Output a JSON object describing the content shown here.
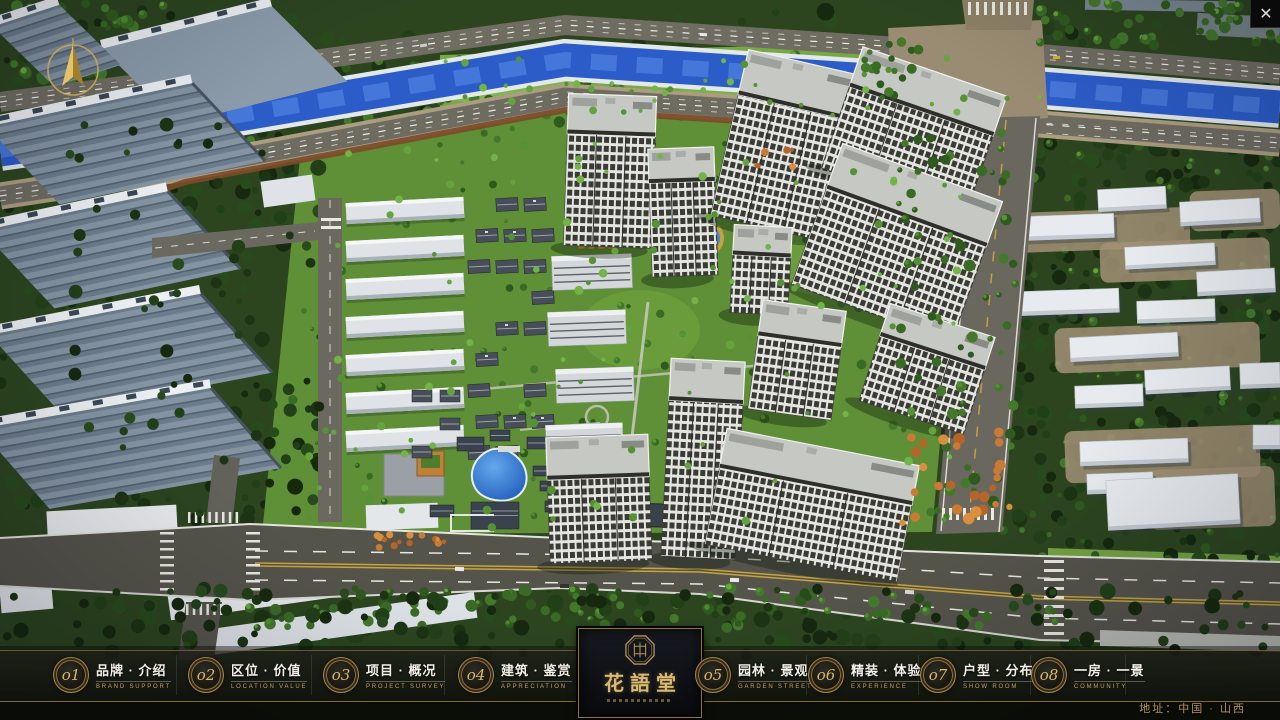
{
  "window": {
    "close_glyph": "✕"
  },
  "nav": {
    "items": [
      {
        "num": "o1",
        "zh": "品牌 · 介绍",
        "en": "BRAND SUPPORT"
      },
      {
        "num": "o2",
        "zh": "区位 · 价值",
        "en": "LOCATION VALUE"
      },
      {
        "num": "o3",
        "zh": "项目 · 概况",
        "en": "PROJECT SURVEY"
      },
      {
        "num": "o4",
        "zh": "建筑 · 鉴赏",
        "en": "APPRECIATION"
      },
      {
        "num": "o5",
        "zh": "园林 · 景观",
        "en": "GARDEN STREET"
      },
      {
        "num": "o6",
        "zh": "精装 · 体验",
        "en": "EXPERIENCE"
      },
      {
        "num": "o7",
        "zh": "户型 · 分布",
        "en": "SHOW ROOM"
      },
      {
        "num": "o8",
        "zh": "一房 · 一景",
        "en": "COMMUNITY"
      }
    ]
  },
  "logo": {
    "title": "花語堂"
  },
  "footer": {
    "address": "地址：中国 · 山西"
  },
  "colors": {
    "gold": "#c2a05a",
    "tree_dark": "#1c3413",
    "river": "#2b5cc8"
  }
}
